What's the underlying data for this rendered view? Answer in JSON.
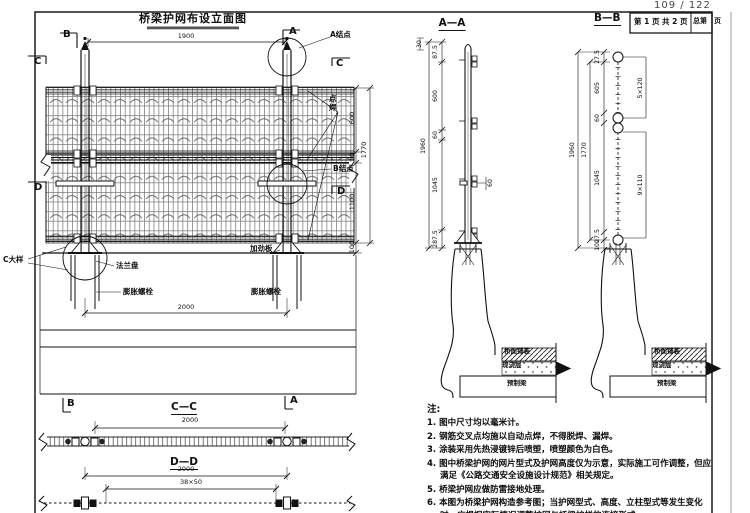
{
  "page": {
    "counter": "109 / 122"
  },
  "titlebar": {
    "drawing_title": "桥梁护网布设立面图",
    "section_bb_title": "B—B",
    "sheet_label": "第 1 页 共 2 页",
    "total_label": "总第　页"
  },
  "elevation": {
    "marker_b": "B",
    "marker_a": "A",
    "marker_c_left": "C",
    "marker_c_right": "C",
    "marker_d_left": "D",
    "marker_d_right": "D",
    "dim_top_span": "1900",
    "dim_right_top": "30",
    "dim_right_600": "600",
    "dim_right_10": "10",
    "dim_right_total": "1770",
    "dim_right_1100": "1100",
    "dim_right_100": "100",
    "dim_anchor_span": "2000",
    "label_node_a": "A结点",
    "label_spot_weld": "点焊",
    "label_node_b": "B结点",
    "label_stiffener": "加劲板",
    "label_detail_c": "C大样",
    "label_flange": "法兰盘",
    "label_anchor_bolt_left": "膨胀螺栓",
    "label_anchor_bolt_right": "膨胀螺栓"
  },
  "section_aa": {
    "title": "A—A",
    "dim_87_5": "87.5",
    "dim_600": "600",
    "dim_60": "60",
    "dim_total": "1960",
    "dim_1045": "1045",
    "dim_287_5": "287.5",
    "dim_offset_60": "60"
  },
  "section_bb": {
    "dim_27_5_top": "27.5",
    "dim_605": "605",
    "dim_60": "60",
    "dim_1770": "1770",
    "dim_1960": "1960",
    "dim_1045": "1045",
    "dim_27_5_bottom": "27.5",
    "dim_100": "100",
    "dim_spacing_top": "5×120",
    "dim_spacing_bottom": "9×110"
  },
  "layers": {
    "pavement": "桥面铺装",
    "cast_layer": "现浇层",
    "precast_beam": "预制梁"
  },
  "section_cc": {
    "title": "C—C",
    "marker_b": "B",
    "marker_a": "A",
    "dim_span": "2000"
  },
  "section_dd": {
    "title": "D—D",
    "dim_span": "2000",
    "dim_spacing": "38×50"
  },
  "notes": {
    "heading": "注:",
    "items": [
      "1. 图中尺寸均以毫米计。",
      "2. 钢筋交叉点均施以自动点焊，不得脱焊、漏焊。",
      "3. 涂装采用先热浸镀锌后喷塑，喷塑颜色为白色。",
      "4. 图中桥梁护网的网片型式及护网高度仅为示意，实际施工可作调整，但应满足《公路交通安全设施设计规范》相关规定。",
      "5. 桥梁护网应做防雷接地处理。",
      "6. 本图为桥梁护网构造参考图；当护网型式、高度、立柱型式等发生变化时，应根据实际情况调整护网与桥梁护栏的连接形式。"
    ]
  }
}
